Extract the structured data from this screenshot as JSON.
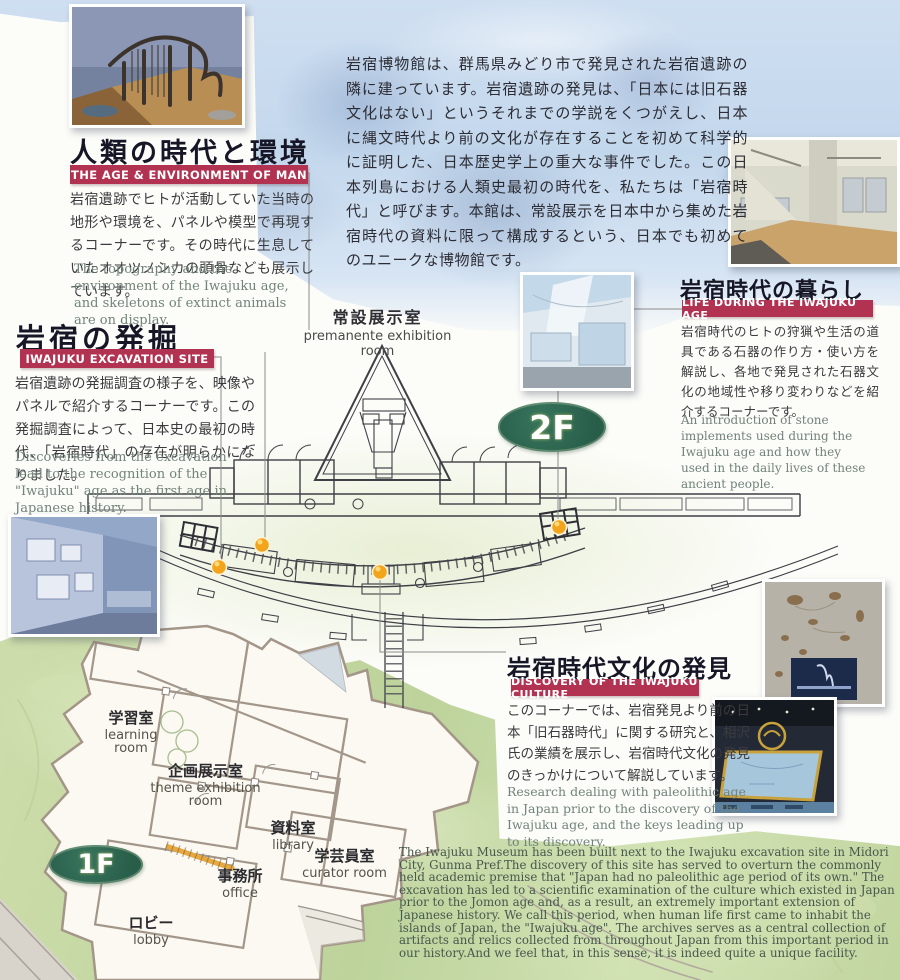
{
  "intro_text": "岩宿博物館は、群馬県みどり市で発見された岩宿遺跡の隣に建っています。岩宿遺跡の発見は、「日本には旧石器文化はない」というそれまでの学説をくつがえし、日本に縄文時代より前の文化が存在することを初めて科学的に証明した、日本歴史学上の重大な事件でした。この日本列島における人類史最初の時代を、私たちは「岩宿時代」と呼びます。本館は、常設展示を日本中から集めた岩宿時代の資料に限って構成するという、日本でも初めてのユニークな博物館です。",
  "sections": {
    "age": {
      "title": "人類の時代と環境",
      "banner": "THE AGE & ENVIRONMENT OF MAN",
      "body_ja": "岩宿遺跡でヒトが活動していた当時の地形や環境を、パネルや模型で再現するコーナーです。その時代に生息していたオオツノシカの頭骨なども展示しています。",
      "body_en": "The topography and the environment of the Iwajuku age, and skeletons of extinct animals are on display."
    },
    "excavation": {
      "title": "岩宿の発掘",
      "banner": "IWAJUKU EXCAVATION SITE",
      "body_ja": "岩宿遺跡の発掘調査の様子を、映像やパネルで紹介するコーナーです。この発掘調査によって、日本史の最初の時代、「岩宿時代」の存在が明らかになりました。",
      "body_en": "Discoveries from the excavation lead to the recognition of the \"Iwajuku\" age as the first age in Japanese history."
    },
    "life": {
      "title": "岩宿時代の暮らし",
      "banner": "LIFE DURING THE IWAJUKU AGE",
      "body_ja": "岩宿時代のヒトの狩猟や生活の道具である石器の作り方・使い方を解説し、各地で発見された石器文化の地域性や移り変わりなどを紹介するコーナーです。",
      "body_en": "An introduction of stone implements used during the Iwajuku age and how they used in the daily lives of these ancient people."
    },
    "discovery": {
      "title": "岩宿時代文化の発見",
      "banner": "DISCOVERY OF THE IWAJUKU CULTURE",
      "body_ja": "このコーナーでは、岩宿発見より前の日本「旧石器時代」に関する研究と、相沢氏の業績を展示し、岩宿時代文化の発見のきっかけについて解説しています。",
      "body_en": "Research dealing with paleolithic age in Japan prior to the discovery of the Iwajuku age, and the keys leading up to its discovery."
    }
  },
  "floor2": {
    "badge": "2F",
    "room_ja": "常設展示室",
    "room_en": "premanente exhibition room"
  },
  "floor1": {
    "badge": "1F",
    "rooms": {
      "learning": {
        "ja": "学習室",
        "en": "learning room"
      },
      "theme": {
        "ja": "企画展示室",
        "en": "theme exhibition room"
      },
      "library": {
        "ja": "資料室",
        "en": "library"
      },
      "curator": {
        "ja": "学芸員室",
        "en": "curator room"
      },
      "office": {
        "ja": "事務所",
        "en": "office"
      },
      "lobby": {
        "ja": "ロビー",
        "en": "lobby"
      }
    }
  },
  "footer_en": "The Iwajuku Museum has been built next to the Iwajuku excavation site in Midori City, Gunma Pref.The discovery of this site has served to overturn the commonly held academic premise that \"Japan had no paleolithic age period of its own.\" The excavation has led to a scientific examination of the culture which existed in Japan prior to the Jomon age and, as a result, an extremely important extension of Japanese history. We call this period, when human life first came to inhabit the islands of Japan, the \"Iwajuku age\". The archives serves as a central collection of artifacts and relics collected from throughout Japan from this important period in our history.And we feel that, in this sense, it is indeed quite a unique facility.",
  "colors": {
    "banner_red": "#b23252",
    "badge_green": "#2e6b56",
    "dot_amber": "#f2a41d"
  }
}
